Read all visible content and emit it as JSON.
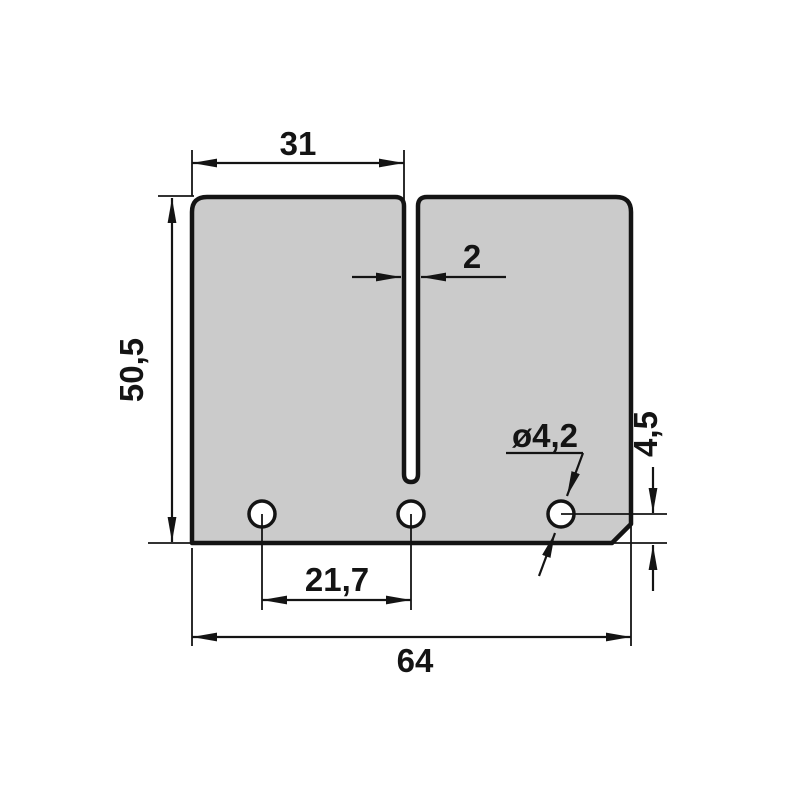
{
  "drawing": {
    "kind": "technical-dimension-drawing",
    "colors": {
      "background": "#ffffff",
      "plate_fill": "#cbcbcb",
      "line": "#141414",
      "hole_fill": "#ffffff"
    },
    "labels": {
      "top_width": "31",
      "slot_width": "2",
      "height": "50,5",
      "hole_diameter": "ø4,2",
      "hole_edge_offset": "4,5",
      "hole_spacing": "21,7",
      "total_width": "64"
    }
  }
}
